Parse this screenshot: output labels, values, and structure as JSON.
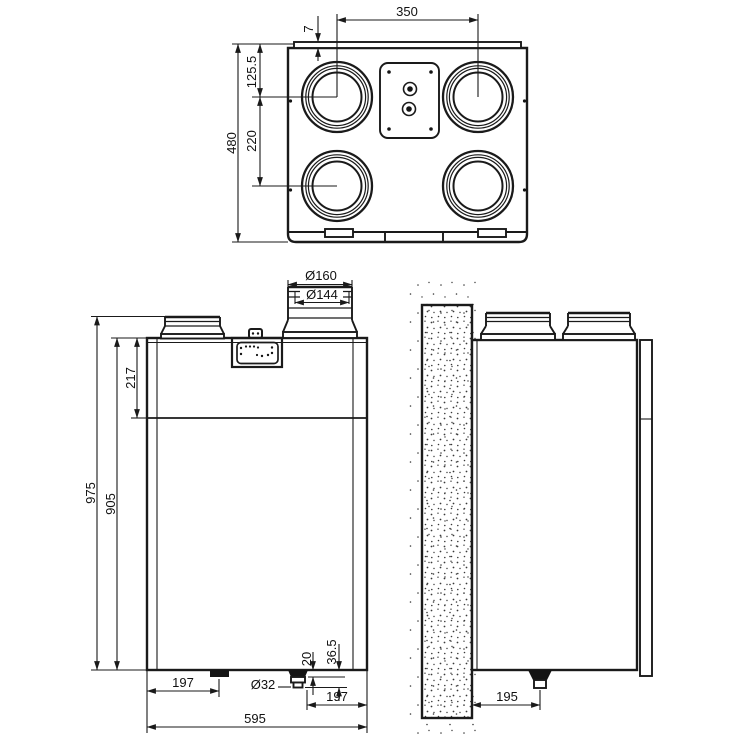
{
  "top_view": {
    "port_span": "350",
    "lip_height": "7",
    "port_center_from_top": "125.5",
    "port_pitch": "220",
    "depth": "480"
  },
  "front_view": {
    "duct_outer_dia": "Ø160",
    "duct_inner_dia": "Ø144",
    "top_section_height": "217",
    "total_height": "975",
    "body_height": "905",
    "left_foot_offset": "197",
    "drain_dia": "Ø32",
    "drain_step_1": "20",
    "drain_step_2": "36.5",
    "drain_offset_right": "197",
    "body_width": "595"
  },
  "side_view": {
    "drain_from_wall": "195"
  }
}
